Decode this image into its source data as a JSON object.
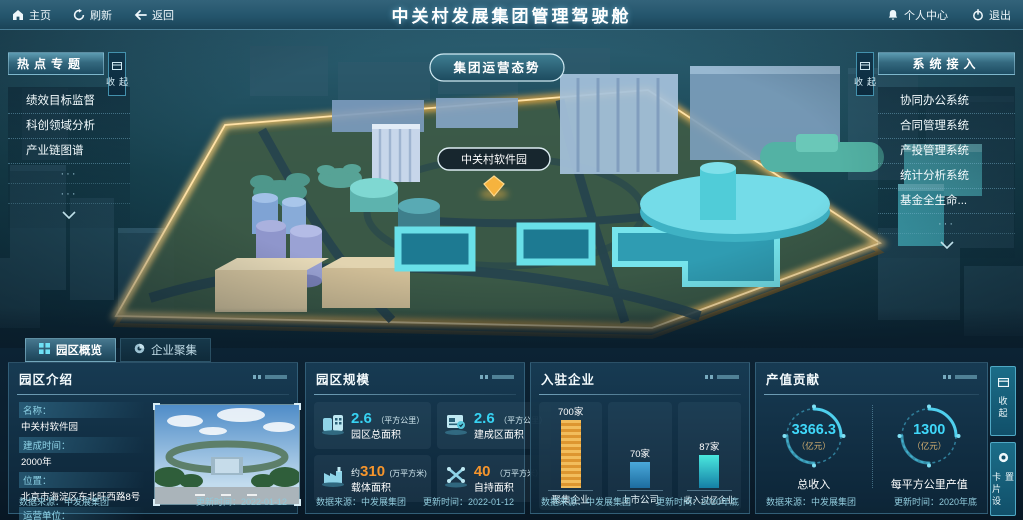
{
  "header": {
    "title": "中关村发展集团管理驾驶舱",
    "nav_left": [
      {
        "label": "主页"
      },
      {
        "label": "刷新"
      },
      {
        "label": "返回"
      }
    ],
    "nav_right": [
      {
        "label": "个人中心"
      },
      {
        "label": "退出"
      }
    ]
  },
  "map": {
    "mode_button": "集团运营态势",
    "marker_label": "中关村软件园"
  },
  "left_panel": {
    "title": "热点专题",
    "collapse_label": "收起",
    "items": [
      "绩效目标监督",
      "科创领域分析",
      "产业链图谱"
    ],
    "more": "···"
  },
  "right_panel": {
    "title": "系统接入",
    "collapse_label": "收起",
    "items": [
      "协同办公系统",
      "合同管理系统",
      "产投管理系统",
      "统计分析系统",
      "基金全生命..."
    ],
    "more": "···"
  },
  "tabs": [
    {
      "label": "园区概览"
    },
    {
      "label": "企业聚集"
    }
  ],
  "panels": {
    "intro": {
      "title": "园区介绍",
      "fields": [
        {
          "label": "名称：",
          "value": "中关村软件园"
        },
        {
          "label": "建成时间：",
          "value": "2000年"
        },
        {
          "label": "位置：",
          "value": "北京市海淀区东北旺西路8号"
        },
        {
          "label": "运营单位：",
          "value": "北京中关村软件园发展有限公司"
        }
      ],
      "source": "数据来源：中发展集团",
      "updated": "更新时间：2022-01-12"
    },
    "scale": {
      "title": "园区规模",
      "stats": [
        {
          "prefix": "",
          "value": "2.6",
          "unit": "（平方公里）",
          "label": "园区总面积"
        },
        {
          "prefix": "",
          "value": "2.6",
          "unit": "（平方公里）",
          "label": "建成区面积"
        },
        {
          "prefix": "约",
          "value": "310",
          "unit": "(万平方米)",
          "label": "载体面积"
        },
        {
          "prefix": "",
          "value": "40",
          "unit": "（万平方米）",
          "label": "自持面积"
        }
      ],
      "source": "数据来源：中发展集团",
      "updated": "更新时间：2022-01-12"
    },
    "enterprises": {
      "title": "入驻企业",
      "chart_data": {
        "type": "bar",
        "categories": [
          "聚集企业",
          "上市公司",
          "收入过亿企业"
        ],
        "values": [
          700,
          70,
          87
        ],
        "value_labels": [
          "700家",
          "70家",
          "87家"
        ],
        "bar_heights_px": [
          68,
          26,
          33
        ],
        "bar_colors": [
          "#e8a53c",
          "#3390c2",
          "#2ed0cf"
        ]
      },
      "source": "数据来源：中发展集团",
      "updated": "更新时间：2020年底"
    },
    "output": {
      "title": "产值贡献",
      "gauges": [
        {
          "value": "3366.3",
          "unit": "（亿元）",
          "label": "总收入"
        },
        {
          "value": "1300",
          "unit": "（亿元）",
          "label": "每平方公里产值"
        }
      ],
      "source": "数据来源：中发展集团",
      "updated": "更新时间：2020年底"
    }
  },
  "side_buttons": [
    {
      "label": "收起"
    },
    {
      "label": "卡片设置"
    }
  ],
  "colors": {
    "accent_cyan": "#37d2f2",
    "accent_orange": "#f6952c",
    "gold": "#f2b14e"
  }
}
